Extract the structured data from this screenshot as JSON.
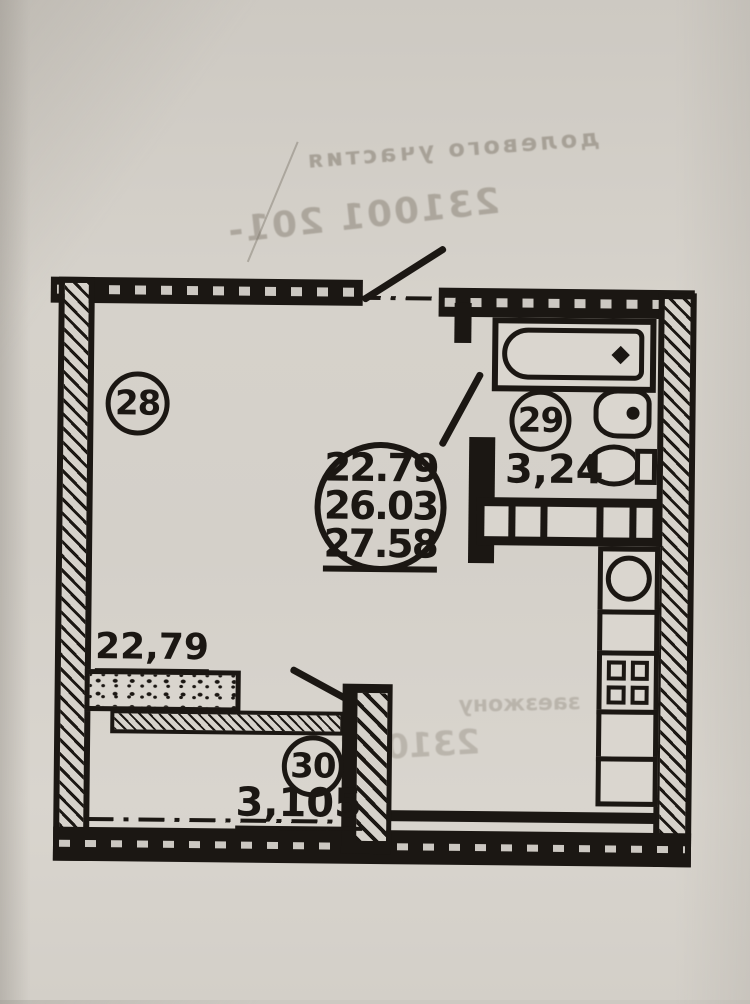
{
  "colors": {
    "paper": "#d5d1ca",
    "ink": "#1b1713",
    "ghost": "#7d7568"
  },
  "rooms": [
    {
      "number": "28",
      "area": "22,79"
    },
    {
      "number": "29",
      "area": "3,24"
    },
    {
      "number": "30",
      "area": "3,105"
    }
  ],
  "stamp": {
    "line1": "22.79",
    "line2": "26.03",
    "line3": "27.58"
  },
  "ghost_texts": {
    "line1": "долевого участия",
    "line2": "231001 201-",
    "line3": "231005",
    "line4": "заезжону"
  }
}
